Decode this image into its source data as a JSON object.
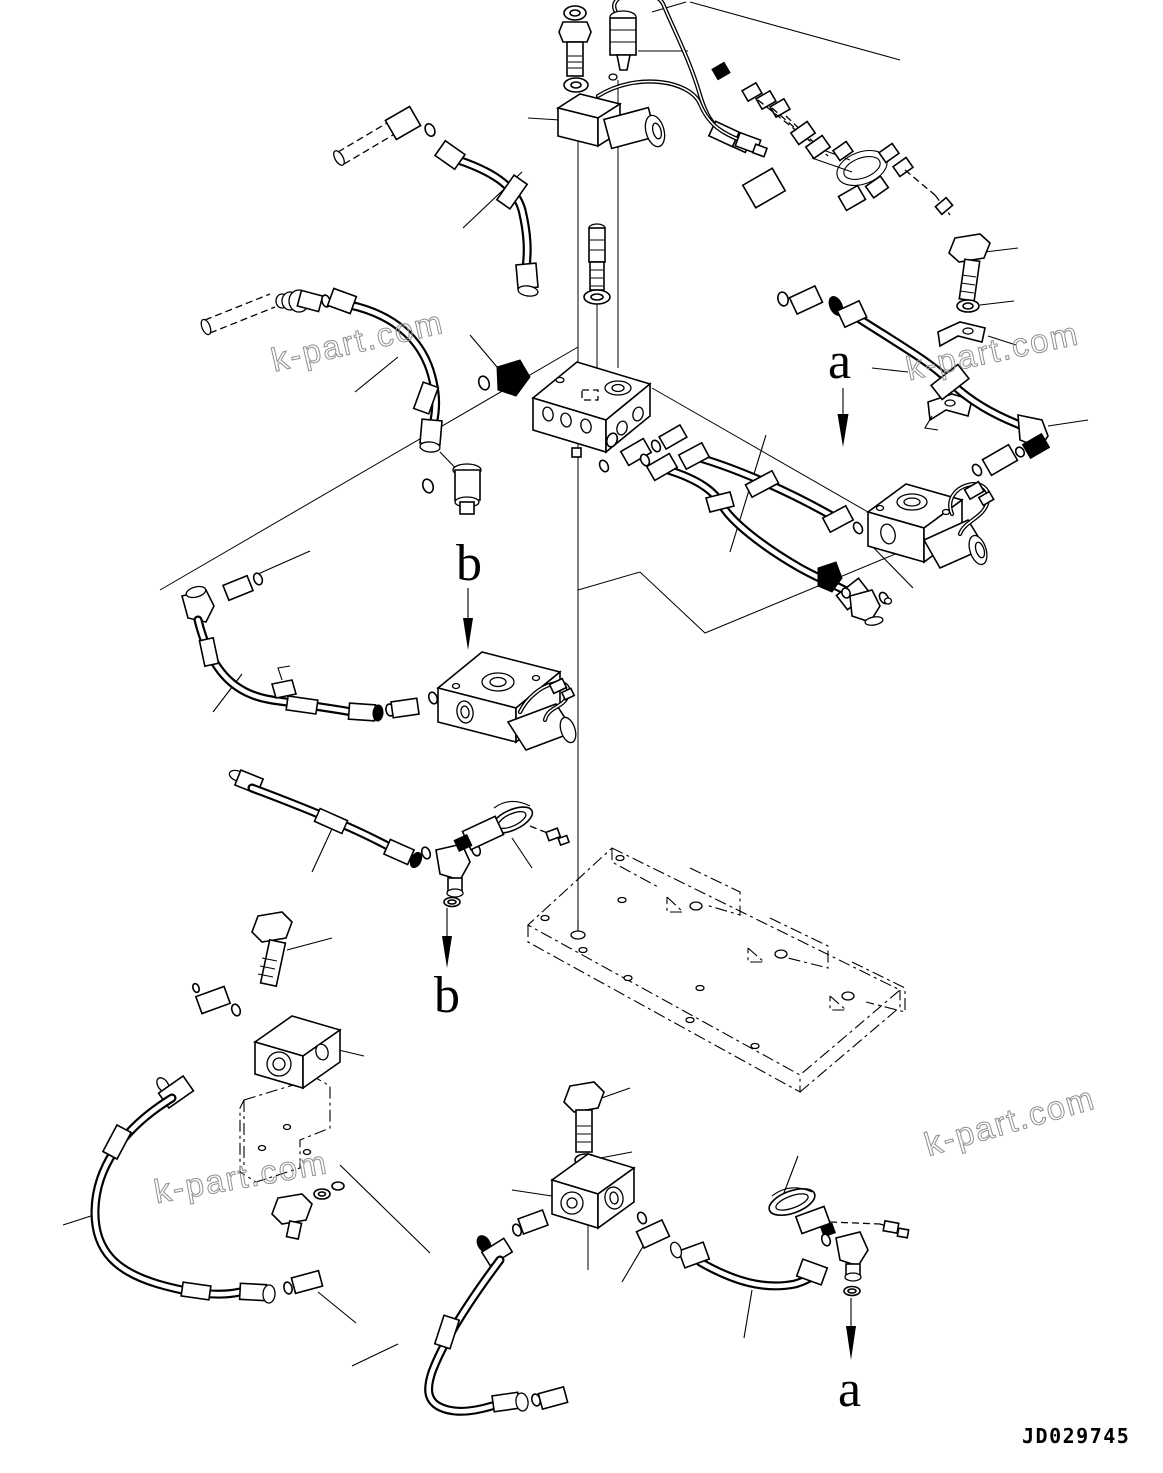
{
  "page": {
    "background_color": "#ffffff",
    "line_color": "#000000"
  },
  "drawing_number": "JD029745",
  "callouts": {
    "a": "a",
    "b": "b"
  },
  "watermark": {
    "text": "k-part.com",
    "color": "#8f8f8f"
  }
}
